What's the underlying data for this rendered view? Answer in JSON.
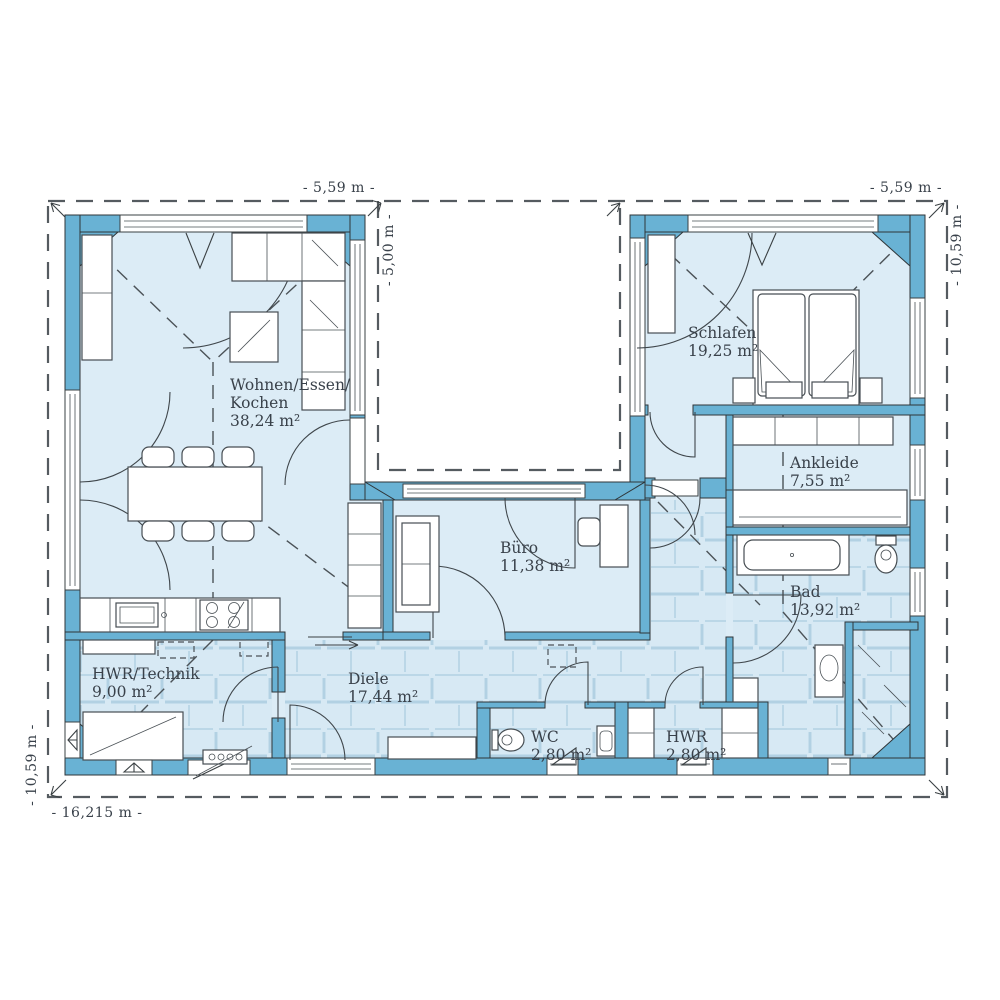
{
  "plan_title": "Bungalow U-shaped floor plan",
  "rooms": [
    {
      "id": "wohnen",
      "name_line1": "Wohnen/Essen/",
      "name_line2": "Kochen",
      "area": "38,24 m²"
    },
    {
      "id": "schlafen",
      "name": "Schlafen",
      "area": "19,25 m²"
    },
    {
      "id": "ankleide",
      "name": "Ankleide",
      "area": "7,55 m²"
    },
    {
      "id": "buero",
      "name": "Büro",
      "area": "11,38 m²"
    },
    {
      "id": "diele",
      "name": "Diele",
      "area": "17,44 m²"
    },
    {
      "id": "hwr_technik",
      "name": "HWR/Technik",
      "area": "9,00 m²"
    },
    {
      "id": "wc",
      "name": "WC",
      "area": "2,80 m²"
    },
    {
      "id": "hwr",
      "name": "HWR",
      "area": "2,80 m²"
    },
    {
      "id": "bad",
      "name": "Bad",
      "area": "13,92 m²"
    }
  ],
  "dimensions": {
    "top_left": "- 5,59 m -",
    "top_right": "- 5,59 m -",
    "courtyard_depth": "- 5,00 m -",
    "right_side": "- 10,59 m -",
    "left_side": "- 10,59 m -",
    "bottom": "- 16,215 m -"
  },
  "colors": {
    "wall": "#69b2d4",
    "room": "#dcecf6",
    "tile": "#d7e9f4",
    "tile_line": "#b2d1e3",
    "text": "#39414a"
  }
}
